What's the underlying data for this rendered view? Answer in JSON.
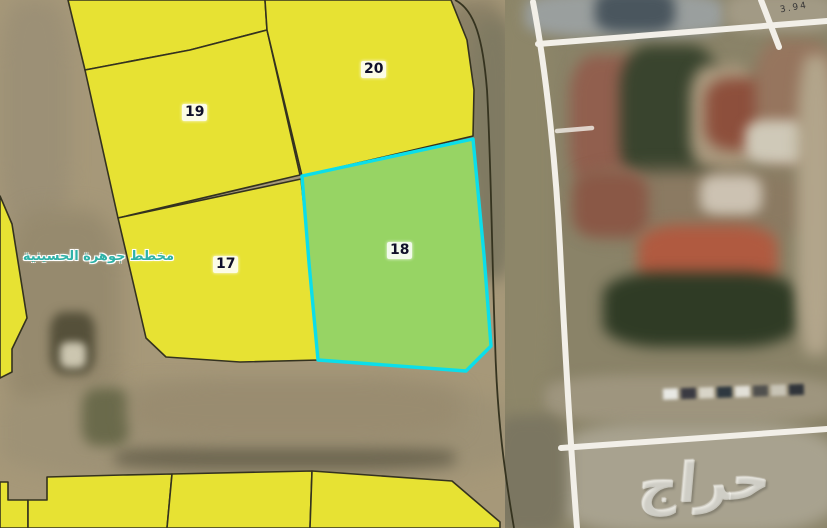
{
  "map": {
    "plan_label": "مخطط جوهرة الحسينية",
    "parcels": {
      "p17": {
        "label": "17",
        "highlighted": false
      },
      "p18": {
        "label": "18",
        "highlighted": true
      },
      "p19": {
        "label": "19",
        "highlighted": false
      },
      "p20": {
        "label": "20",
        "highlighted": false
      }
    },
    "dimension_label": "3.94",
    "colors": {
      "parcel_yellow": "#e7e233",
      "highlight_green": "#97d464",
      "highlight_cyan": "#0bdeea",
      "road_tan": "#a69879",
      "boundary_white": "#f2efe8",
      "plan_label_teal": "#2fb2a8"
    }
  },
  "watermark": {
    "text": "حراج"
  }
}
